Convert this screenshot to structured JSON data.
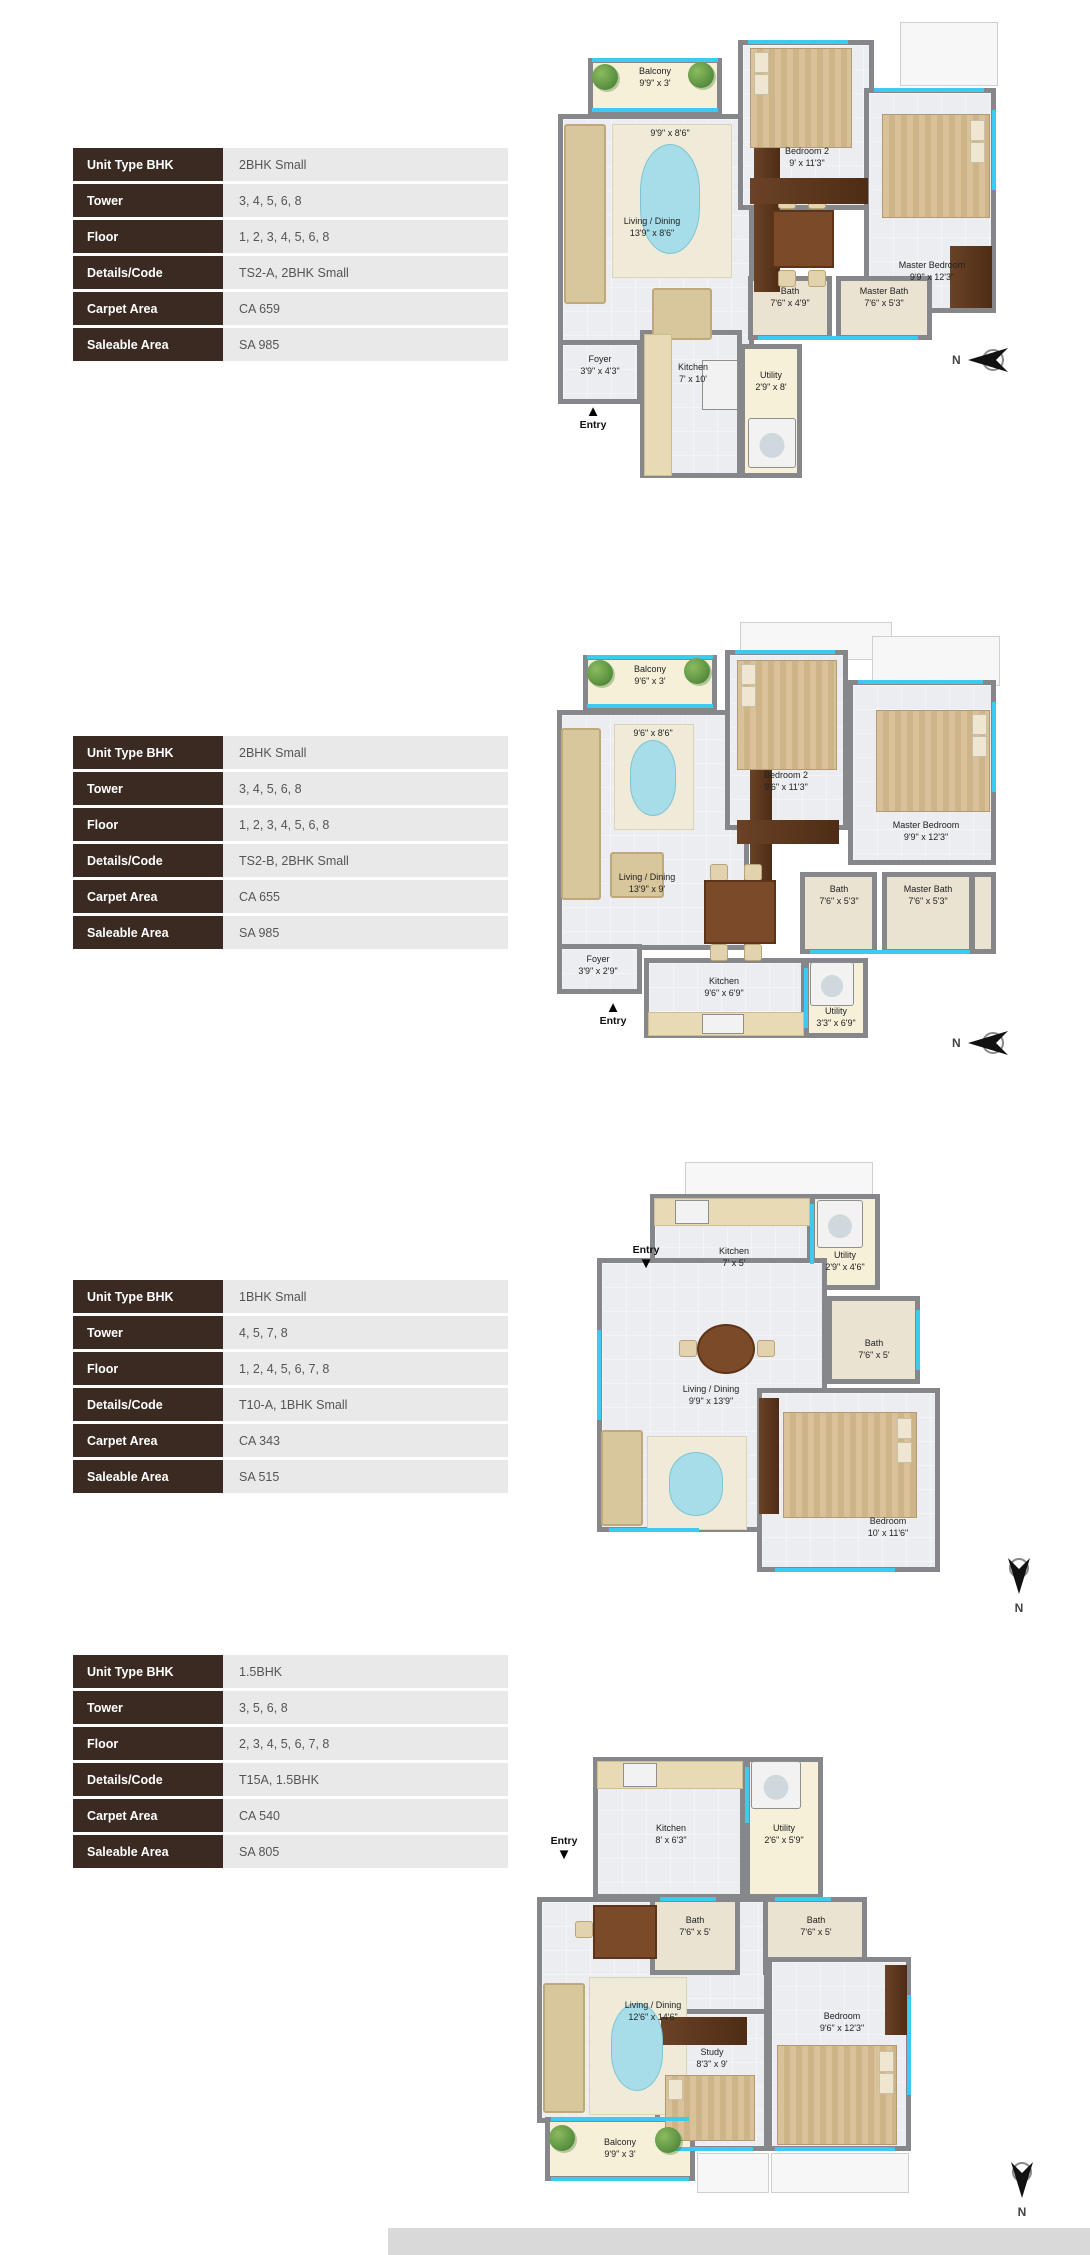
{
  "colors": {
    "table_label_bg": "#3A2A21",
    "table_value_bg": "#E9E9E9",
    "wall": "#85878A",
    "floor": "#ECEDF0",
    "balcony_floor": "#F6F0D8",
    "window_accent": "#3CC9F2",
    "wood": "#6A4226"
  },
  "sections": [
    {
      "table": {
        "rows": [
          {
            "label": "Unit Type BHK",
            "value": "2BHK Small"
          },
          {
            "label": "Tower",
            "value": "3, 4, 5, 6, 8"
          },
          {
            "label": "Floor",
            "value": "1, 2, 3, 4, 5, 6, 8"
          },
          {
            "label": "Details/Code",
            "value": "TS2-A, 2BHK Small"
          },
          {
            "label": "Carpet Area",
            "value": "CA 659"
          },
          {
            "label": "Saleable Area",
            "value": "SA 985"
          }
        ]
      },
      "plan": {
        "entry_label": "Entry",
        "entry_arrow": "▲",
        "compass_label": "N",
        "balcony": {
          "name": "Balcony",
          "dims": "9'9\" x 3'"
        },
        "rug": {
          "dims": "9'9\" x 8'6\""
        },
        "bedroom2": {
          "name": "Bedroom 2",
          "dims": "9' x 11'3\""
        },
        "master_bedroom": {
          "name": "Master Bedroom",
          "dims": "9'9\" x 12'3\""
        },
        "living": {
          "name": "Living / Dining",
          "dims": "13'9\" x 8'6\""
        },
        "bath": {
          "name": "Bath",
          "dims": "7'6\" x 4'9\""
        },
        "master_bath": {
          "name": "Master Bath",
          "dims": "7'6\" x 5'3\""
        },
        "foyer": {
          "name": "Foyer",
          "dims": "3'9\" x 4'3\""
        },
        "kitchen": {
          "name": "Kitchen",
          "dims": "7' x 10'"
        },
        "utility": {
          "name": "Utility",
          "dims": "2'9\" x 8'"
        }
      }
    },
    {
      "table": {
        "rows": [
          {
            "label": "Unit Type BHK",
            "value": "2BHK Small"
          },
          {
            "label": "Tower",
            "value": "3, 4, 5, 6, 8"
          },
          {
            "label": "Floor",
            "value": "1, 2, 3, 4, 5, 6, 8"
          },
          {
            "label": "Details/Code",
            "value": "TS2-B, 2BHK Small"
          },
          {
            "label": "Carpet Area",
            "value": "CA 655"
          },
          {
            "label": "Saleable Area",
            "value": "SA 985"
          }
        ]
      },
      "plan": {
        "entry_label": "Entry",
        "entry_arrow": "▲",
        "compass_label": "N",
        "balcony": {
          "name": "Balcony",
          "dims": "9'6\" x 3'"
        },
        "rug": {
          "dims": "9'6\" x 8'6\""
        },
        "bedroom2": {
          "name": "Bedroom 2",
          "dims": "9'6\" x 11'3\""
        },
        "master_bedroom": {
          "name": "Master Bedroom",
          "dims": "9'9\" x 12'3\""
        },
        "living": {
          "name": "Living / Dining",
          "dims": "13'9\" x 9'"
        },
        "bath": {
          "name": "Bath",
          "dims": "7'6\" x 5'3\""
        },
        "master_bath": {
          "name": "Master Bath",
          "dims": "7'6\" x 5'3\""
        },
        "foyer": {
          "name": "Foyer",
          "dims": "3'9\" x 2'9\""
        },
        "kitchen": {
          "name": "Kitchen",
          "dims": "9'6\" x 6'9\""
        },
        "utility": {
          "name": "Utility",
          "dims": "3'3\" x 6'9\""
        }
      }
    },
    {
      "table": {
        "rows": [
          {
            "label": "Unit Type BHK",
            "value": "1BHK Small"
          },
          {
            "label": "Tower",
            "value": "4, 5, 7, 8"
          },
          {
            "label": "Floor",
            "value": "1, 2, 4, 5, 6, 7, 8"
          },
          {
            "label": "Details/Code",
            "value": "T10-A, 1BHK Small"
          },
          {
            "label": "Carpet Area",
            "value": "CA 343"
          },
          {
            "label": "Saleable Area",
            "value": "SA 515"
          }
        ]
      },
      "plan": {
        "entry_label": "Entry",
        "entry_arrow": "▼",
        "compass_label": "N",
        "kitchen": {
          "name": "Kitchen",
          "dims": "7' x 5'"
        },
        "utility": {
          "name": "Utility",
          "dims": "2'9\" x 4'6\""
        },
        "bath": {
          "name": "Bath",
          "dims": "7'6\" x 5'"
        },
        "living": {
          "name": "Living / Dining",
          "dims": "9'9\" x 13'9\""
        },
        "bedroom": {
          "name": "Bedroom",
          "dims": "10' x 11'6\""
        }
      }
    },
    {
      "table": {
        "rows": [
          {
            "label": "Unit Type BHK",
            "value": "1.5BHK"
          },
          {
            "label": "Tower",
            "value": "3, 5, 6, 8"
          },
          {
            "label": "Floor",
            "value": "2, 3, 4, 5, 6, 7, 8"
          },
          {
            "label": "Details/Code",
            "value": "T15A, 1.5BHK"
          },
          {
            "label": "Carpet Area",
            "value": "CA 540"
          },
          {
            "label": "Saleable Area",
            "value": "SA 805"
          }
        ]
      },
      "plan": {
        "entry_label": "Entry",
        "entry_arrow": "▼",
        "compass_label": "N",
        "kitchen": {
          "name": "Kitchen",
          "dims": "8' x 6'3\""
        },
        "utility": {
          "name": "Utility",
          "dims": "2'6\" x 5'9\""
        },
        "bath1": {
          "name": "Bath",
          "dims": "7'6\" x 5'"
        },
        "bath2": {
          "name": "Bath",
          "dims": "7'6\" x 5'"
        },
        "living": {
          "name": "Living / Dining",
          "dims": "12'6\" x 14'6\""
        },
        "study": {
          "name": "Study",
          "dims": "8'3\" x 9'"
        },
        "bedroom": {
          "name": "Bedroom",
          "dims": "9'6\" x 12'3\""
        },
        "balcony": {
          "name": "Balcony",
          "dims": "9'9\" x 3'"
        }
      }
    }
  ]
}
